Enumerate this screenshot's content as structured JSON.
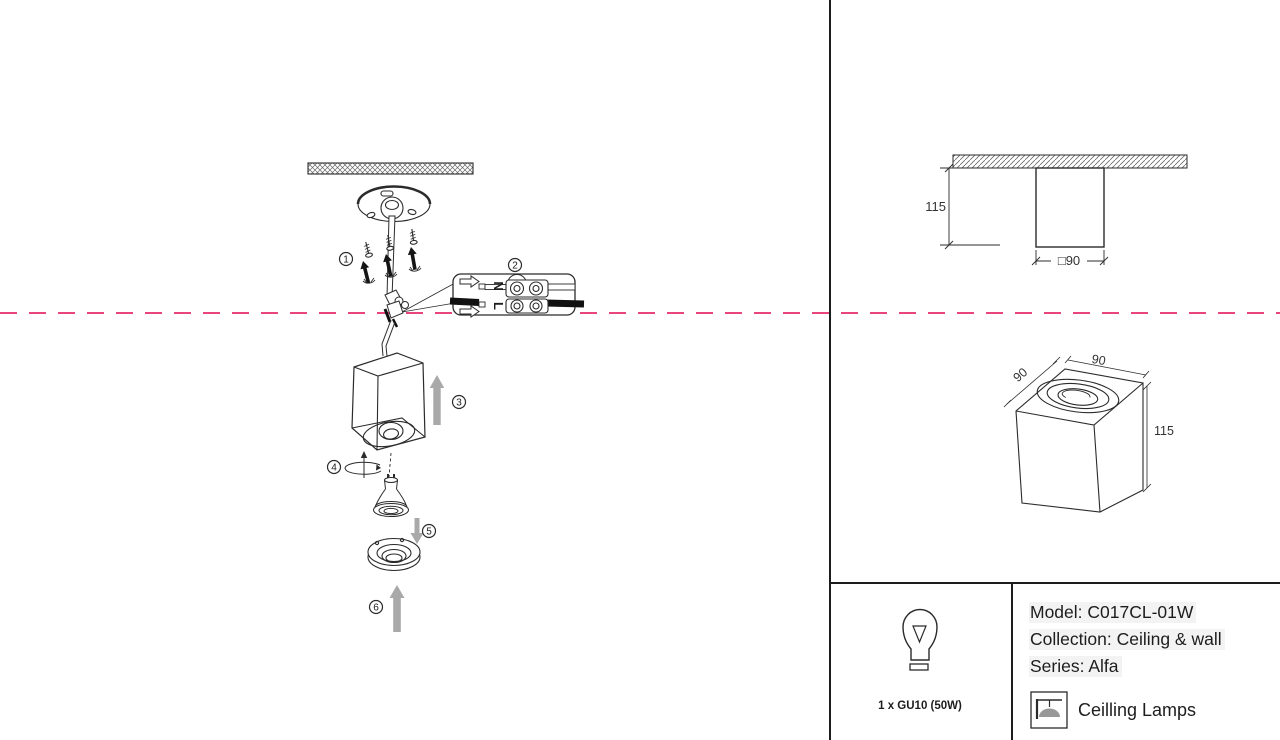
{
  "colors": {
    "cut_line": "#e8447d",
    "arrow_gray": "#a9a9a9",
    "line": "#2b2b2b"
  },
  "steps": {
    "s1": "1",
    "s2": "2",
    "s3": "3",
    "s4": "4",
    "s5": "5",
    "s6": "6"
  },
  "terminal": {
    "neutral": "N",
    "live": "L"
  },
  "front_view": {
    "height": "115",
    "width": "□90"
  },
  "iso_view": {
    "side": "90",
    "top": "90",
    "height": "115"
  },
  "info": {
    "lamp_spec": "1 x GU10 (50W)",
    "model": "Model: C017CL-01W",
    "collection": "Collection: Ceiling & wall",
    "series": "Series: Alfa",
    "category": "Ceilling Lamps"
  }
}
